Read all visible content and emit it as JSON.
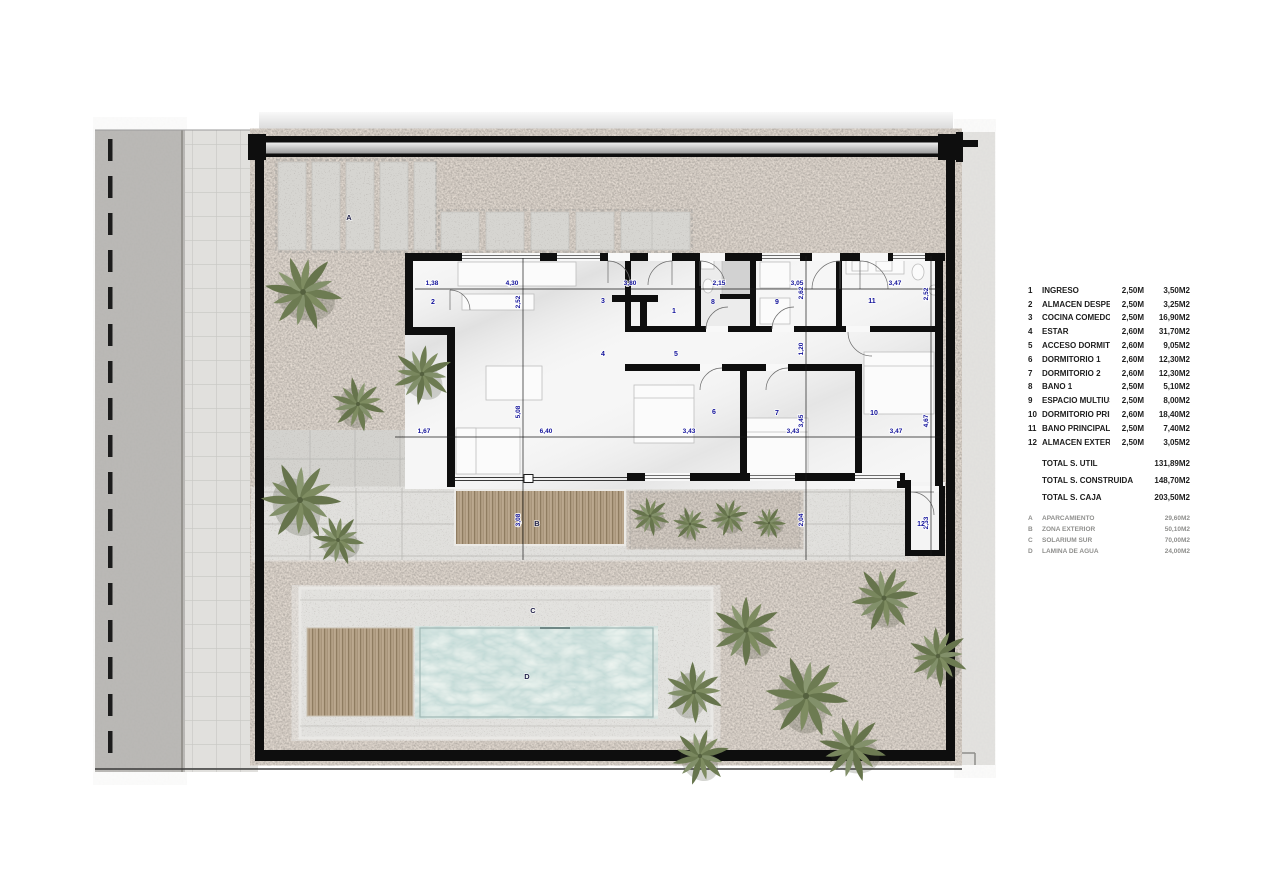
{
  "legend": {
    "rooms": [
      {
        "id": "1",
        "name": "INGRESO",
        "height": "2,50M",
        "area": "3,50M2"
      },
      {
        "id": "2",
        "name": "ALMACEN DESPENSA",
        "height": "2,50M",
        "area": "3,25M2"
      },
      {
        "id": "3",
        "name": "COCINA COMEDOR",
        "height": "2,50M",
        "area": "16,90M2"
      },
      {
        "id": "4",
        "name": "ESTAR",
        "height": "2,60M",
        "area": "31,70M2"
      },
      {
        "id": "5",
        "name": "ACCESO DORMITORIOS",
        "height": "2,60M",
        "area": "9,05M2"
      },
      {
        "id": "6",
        "name": "DORMITORIO 1",
        "height": "2,60M",
        "area": "12,30M2"
      },
      {
        "id": "7",
        "name": "DORMITORIO 2",
        "height": "2,60M",
        "area": "12,30M2"
      },
      {
        "id": "8",
        "name": "BAÑO 1",
        "height": "2,50M",
        "area": "5,10M2"
      },
      {
        "id": "9",
        "name": "ESPACIO MULTIUSOS",
        "height": "2,50M",
        "area": "8,00M2"
      },
      {
        "id": "10",
        "name": "DORMITORIO PRINCIPAL",
        "height": "2,60M",
        "area": "18,40M2"
      },
      {
        "id": "11",
        "name": "BAÑO PRINCIPAL",
        "height": "2,50M",
        "area": "7,40M2"
      },
      {
        "id": "12",
        "name": "ALMACEN EXTERIOR",
        "height": "2,50M",
        "area": "3,05M2"
      }
    ],
    "totals": [
      {
        "label": "TOTAL S. UTIL",
        "value": "131,89M2"
      },
      {
        "label": "TOTAL S. CONSTRUIDA",
        "value": "148,70M2"
      },
      {
        "label": "TOTAL S. CAJA",
        "value": "203,50M2"
      }
    ],
    "zones": [
      {
        "id": "A",
        "name": "APARCAMIENTO",
        "area": "29,60M2"
      },
      {
        "id": "B",
        "name": "ZONA EXTERIOR",
        "area": "50,10M2"
      },
      {
        "id": "C",
        "name": "SOLARIUM SUR",
        "area": "70,00M2"
      },
      {
        "id": "D",
        "name": "LAMINA DE AGUA",
        "area": "24,00M2"
      }
    ]
  },
  "plan": {
    "room_numbers": [
      "1",
      "2",
      "3",
      "4",
      "5",
      "6",
      "7",
      "8",
      "9",
      "10",
      "11",
      "12"
    ],
    "zone_marks": [
      "A",
      "B",
      "C",
      "D"
    ],
    "dims_top": [
      "1,38",
      "4,30",
      "3,80",
      "2,15",
      "3,05",
      "3,47"
    ],
    "dims_mid": [
      "1,67",
      "6,40",
      "3,43",
      "3,43",
      "3,47"
    ],
    "dims_v_left": [
      "2,52",
      "5,08",
      "3,08"
    ],
    "dims_v_center": [
      "2,62",
      "1,20",
      "3,45",
      "2,04"
    ],
    "dims_v_right": [
      "2,52",
      "4,67",
      "2,33"
    ]
  },
  "colors": {
    "wall": "#0e0e0e",
    "gravel": "#8f8880",
    "concrete": "#d6d5d1",
    "wood": "#b3a086",
    "pool_water": "#bfe0dc",
    "road": "#a8a6a3",
    "foliage": "#6d7b52",
    "dim_text": "#12129a"
  }
}
